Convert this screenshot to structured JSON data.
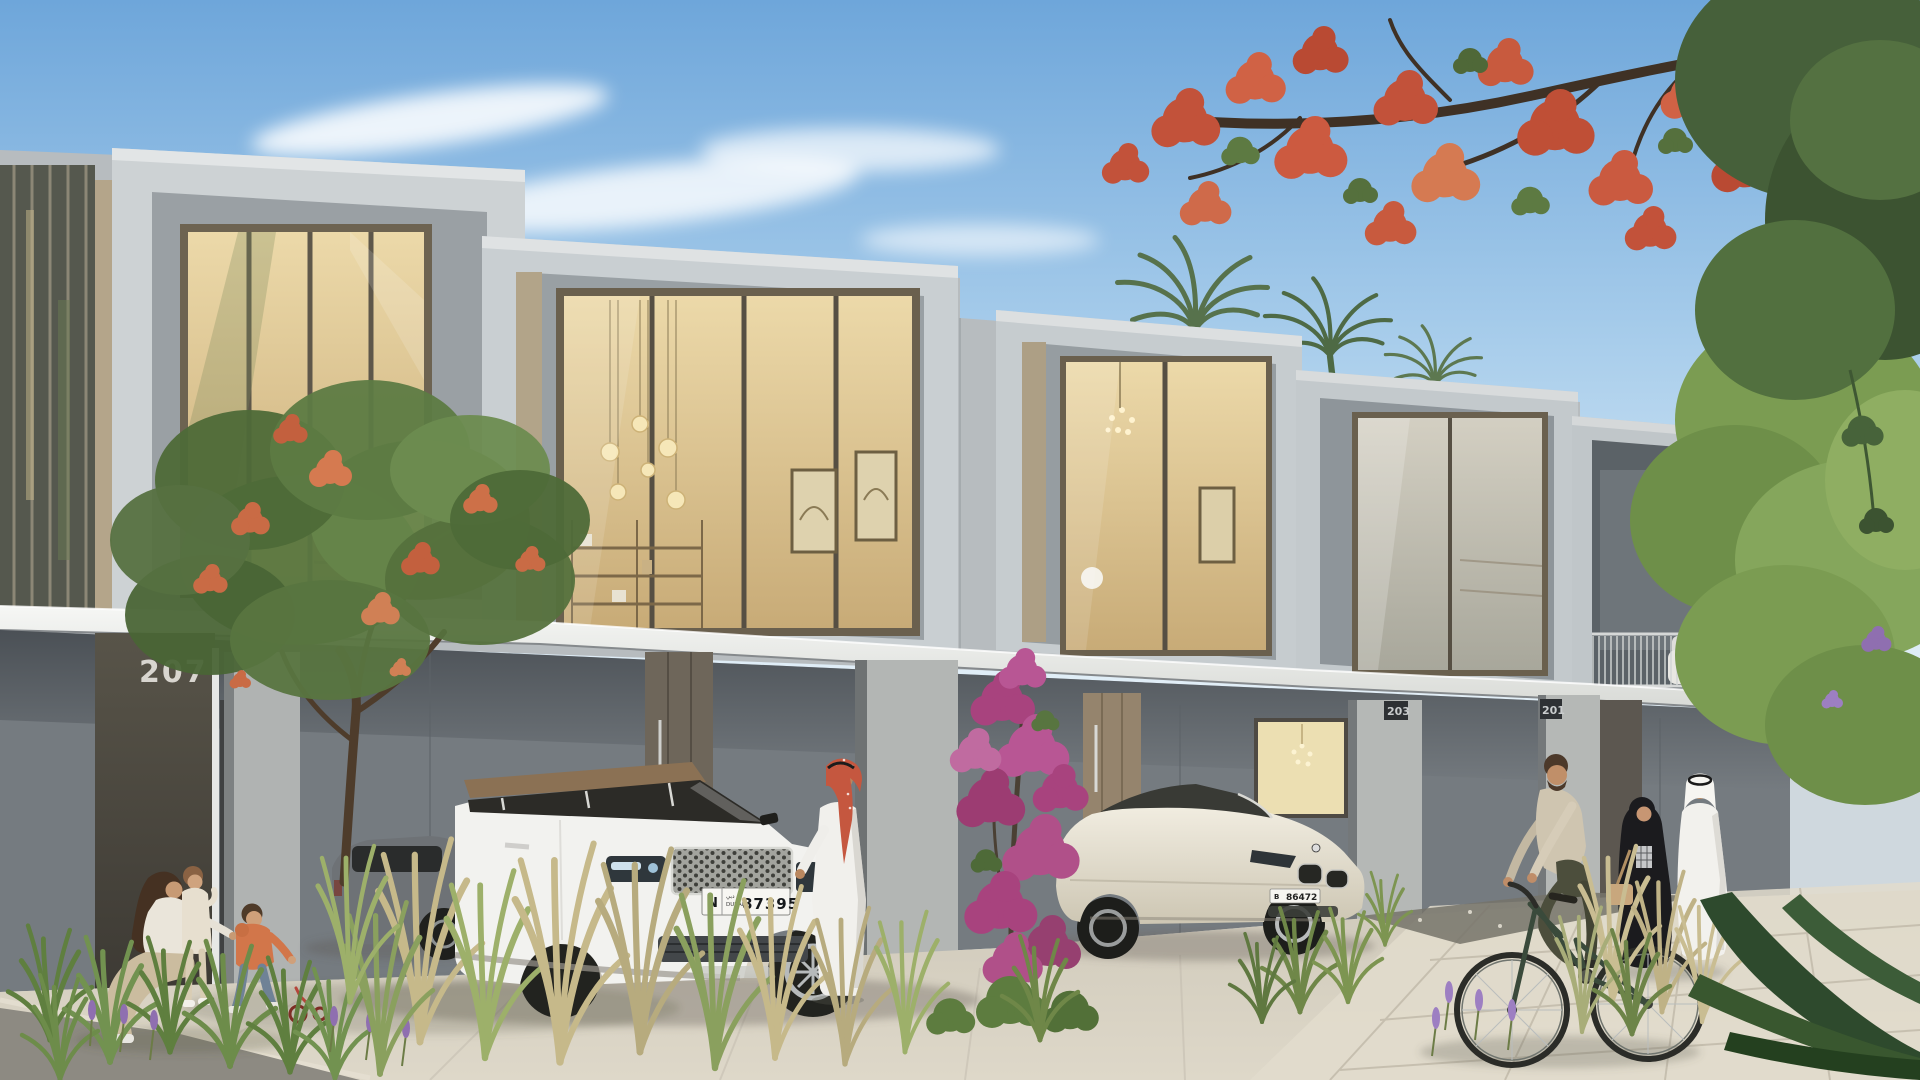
{
  "scene": {
    "label": "townhouse-street-render"
  },
  "signs": {
    "unit_left": "207",
    "unit_middle": "203",
    "unit_right": "201"
  },
  "plates": {
    "suv": {
      "code": "N",
      "sub_top": "دبي",
      "sub_bottom": "DUBAI",
      "number": "87395"
    },
    "coupe": {
      "code": "B",
      "number": "86472"
    }
  },
  "palette": {
    "sky": "#6ea6da",
    "cloud": "#ffffff",
    "facade_light": "#cdd2d4",
    "facade_beige": "#b4a58a",
    "canopy": "#f2f3f1",
    "ground_shade": "#757b80",
    "glass_warm": "#e6d3a4",
    "frame_bronze": "#6a604e",
    "door_wood": "#95846d",
    "pavement": "#d6d0c2",
    "asphalt": "#8d8a82",
    "foliage": "#5d7b43",
    "flame_blossom": "#c8573c",
    "bougainvillea": "#b05089",
    "suv_body": "#f2f2ef",
    "suv_roof": "#8b7154",
    "coupe_body": "#e9e4d6",
    "bicycle": "#3a4a3b",
    "hoodie_orange": "#d2764a",
    "abaya_black": "#1b1b1e",
    "kandura_white": "#f2f1ed",
    "ghutra_red": "#c5573f"
  }
}
